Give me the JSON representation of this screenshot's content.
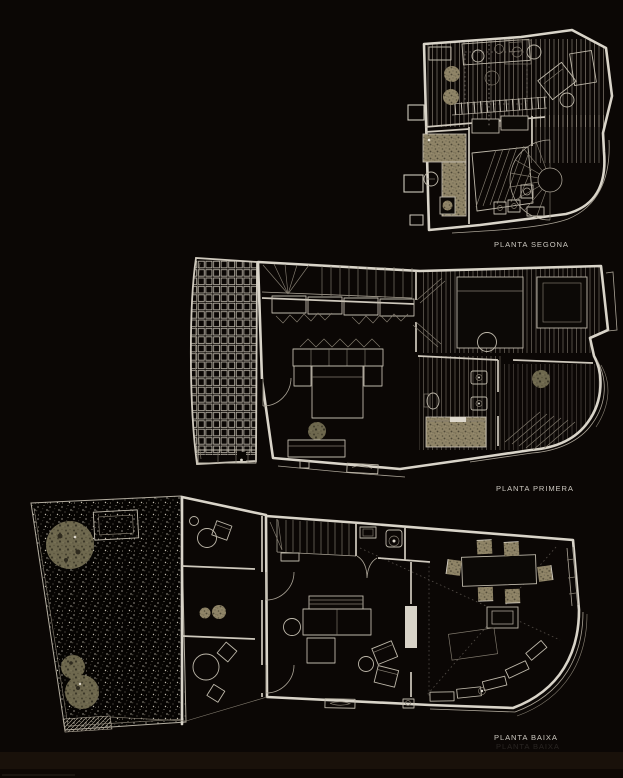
{
  "page": {
    "background_color": "#0b0705",
    "bottom_edge_color": "#1a110a"
  },
  "floor_plans": [
    {
      "id": "planta-segona",
      "label": "PLANTA SEGONA"
    },
    {
      "id": "planta-primera",
      "label": "PLANTA PRIMERA"
    },
    {
      "id": "planta-baixa",
      "label": "PLANTA BAIXA"
    }
  ],
  "colors": {
    "wall_line": "#d9d4c9",
    "thin_line": "#aaa396",
    "label_text": "#cbc7bf",
    "tan_furniture": "#8f8467",
    "olive_tree": "#6e684e"
  }
}
